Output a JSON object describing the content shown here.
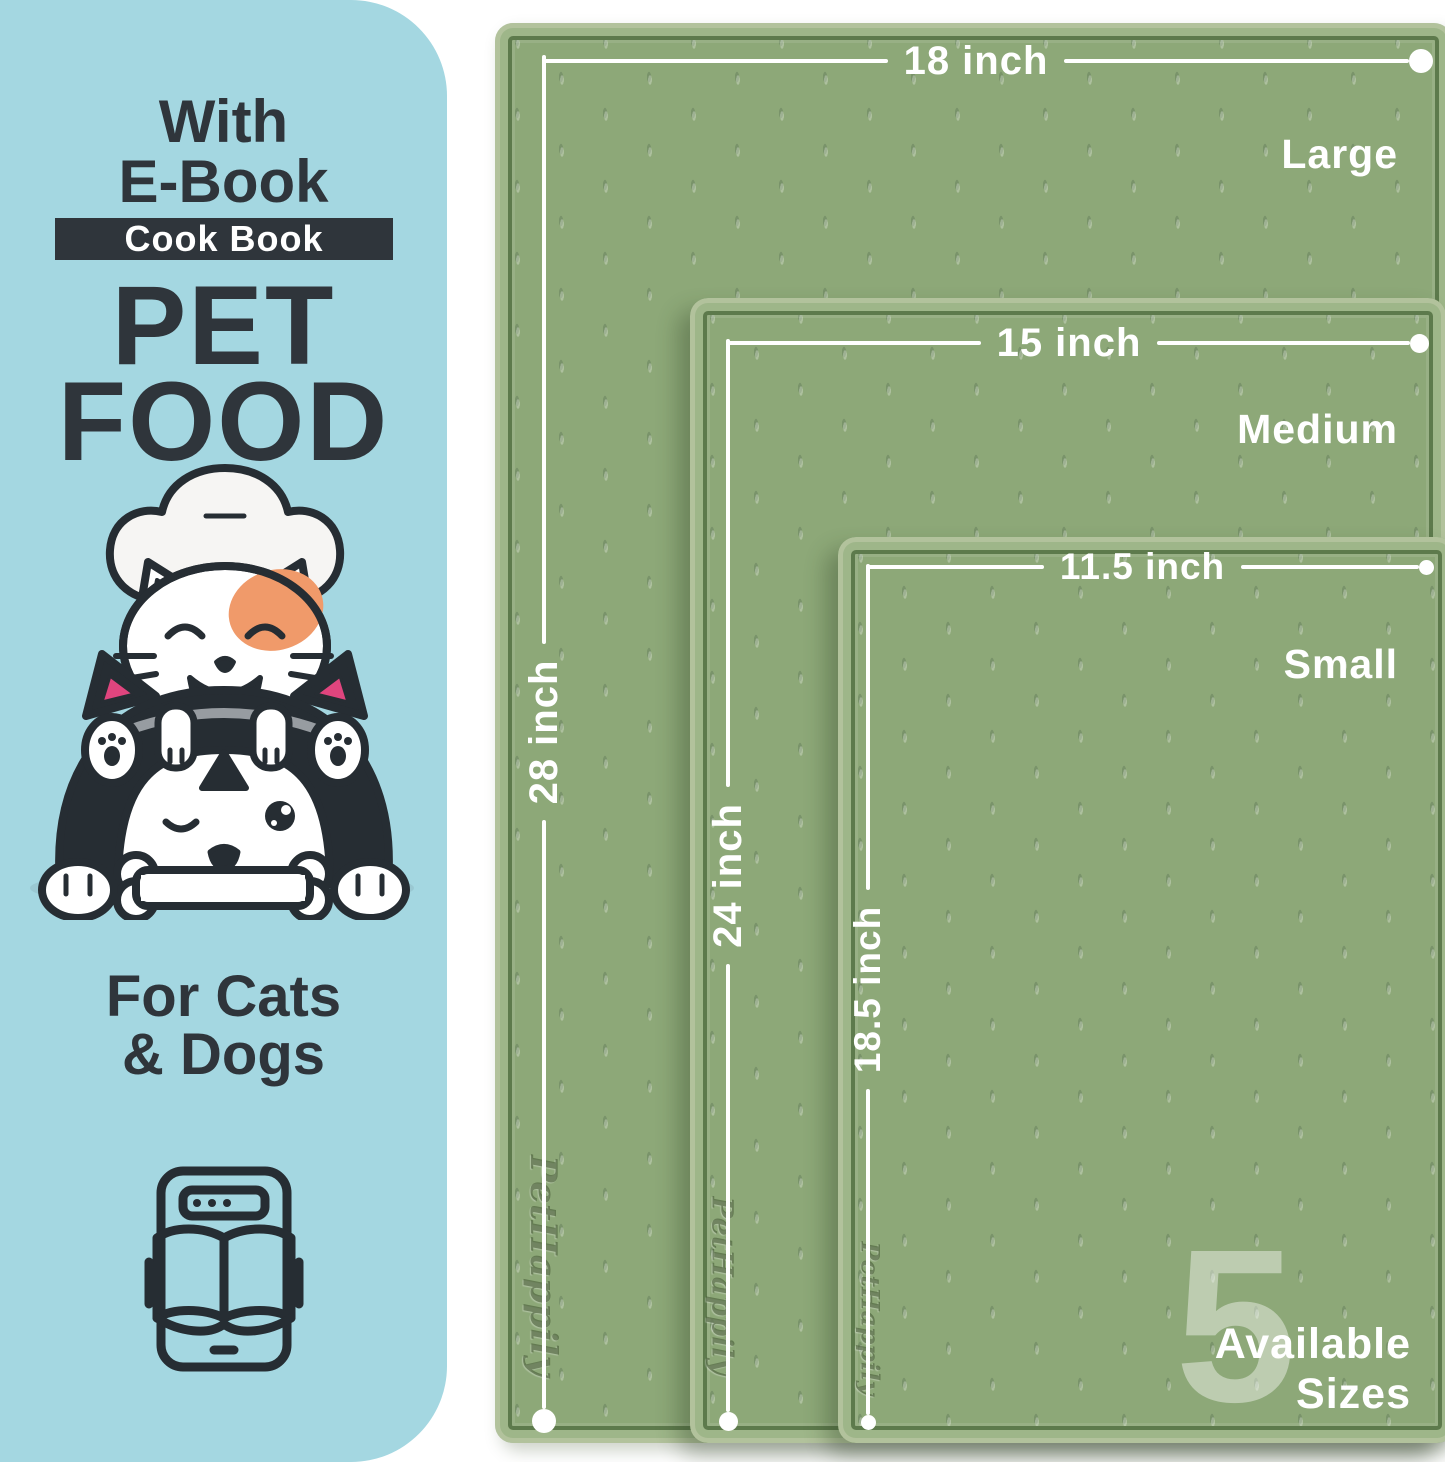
{
  "left_panel": {
    "bg_color": "#a4d7e1",
    "text_color": "#2f353b",
    "tagline_line1": "With",
    "tagline_line2": "E-Book",
    "badge_label": "Cook Book",
    "title_line1": "PET",
    "title_line2": "FOOD",
    "audience_line1": "For Cats",
    "audience_line2": "& Dogs",
    "illustration": "cat-chef-with-winking-dog-and-bone",
    "footer_icon": "tablet-open-book",
    "accent_pink": "#e0457e",
    "accent_orange": "#f09a6a"
  },
  "mat_area": {
    "surface_color": "#8da878",
    "rim_color": "#9eb689",
    "groove_color": "#5d7a4c",
    "line_color": "#ffffff",
    "brand_embossed": "PetHappily",
    "mats": [
      {
        "name": "Large",
        "width_label": "18 inch",
        "length_label": "28 inch"
      },
      {
        "name": "Medium",
        "width_label": "15 inch",
        "length_label": "24 inch"
      },
      {
        "name": "Small",
        "width_label": "11.5 inch",
        "length_label": "18.5 inch"
      }
    ],
    "sizes_badge": {
      "number": "5",
      "line1": "Available",
      "line2": "Sizes"
    }
  }
}
